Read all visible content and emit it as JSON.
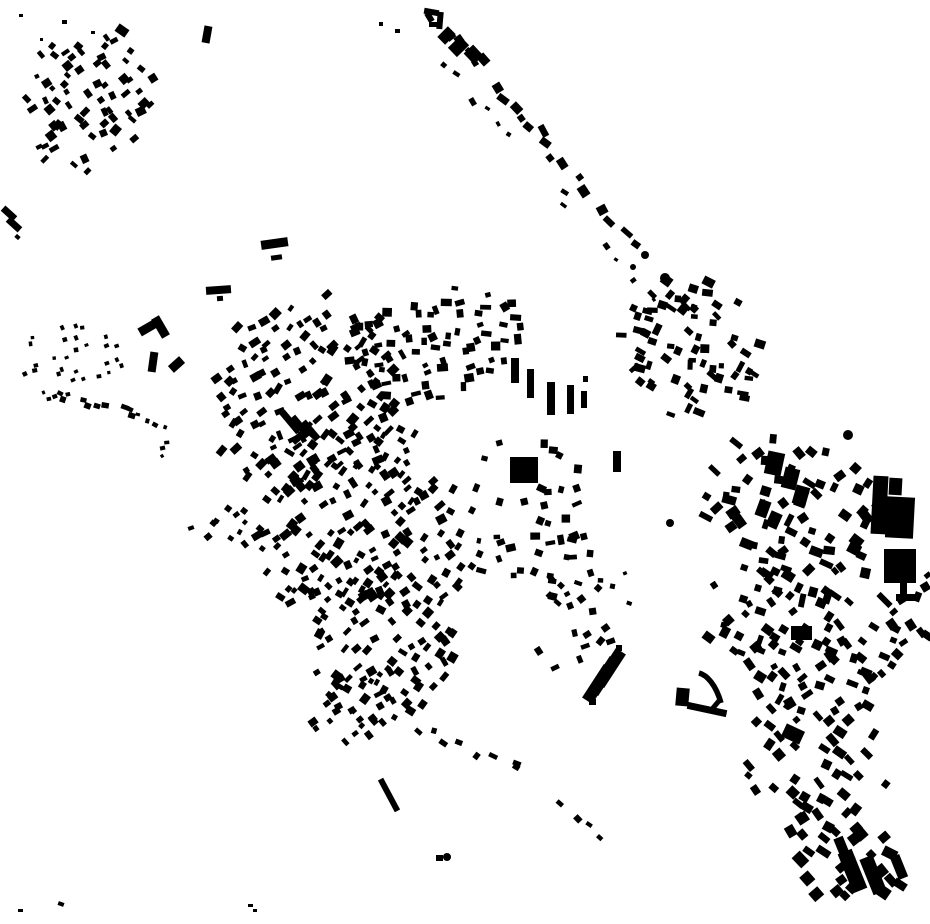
{
  "map": {
    "content": "black building footprints on white background",
    "width": 930,
    "height": 924,
    "background": "#ffffff",
    "building_color": "#000000",
    "holes": [
      [
        505,
        618,
        52,
        40
      ],
      [
        549,
        393,
        50,
        45
      ],
      [
        524,
        470,
        32,
        28
      ]
    ],
    "clusters": [
      {
        "seed": 11,
        "cx": 82,
        "cy": 100,
        "rx": 78,
        "ry": 72,
        "sp": 12,
        "latRot": -38,
        "skip": 0.3,
        "w": [
          4,
          10
        ],
        "h": [
          4,
          9
        ],
        "rot": -38,
        "rotJit": 16
      },
      {
        "seed": 22,
        "cx": 68,
        "cy": 358,
        "rx": 60,
        "ry": 46,
        "sp": 14,
        "latRot": -12,
        "skip": 0.25,
        "w": [
          3,
          5
        ],
        "h": [
          3,
          5
        ],
        "rot": -15,
        "rotJit": 10
      },
      {
        "seed": 25,
        "cx": 160,
        "cy": 452,
        "rx": 22,
        "ry": 16,
        "sp": 11,
        "latRot": -20,
        "skip": 0.4,
        "w": [
          3,
          6
        ],
        "h": [
          3,
          5
        ],
        "rot": -20,
        "rotJit": 15
      },
      {
        "seed": 31,
        "cx": 310,
        "cy": 395,
        "rx": 105,
        "ry": 100,
        "sp": 12,
        "latRot": -40,
        "skip": 0.3,
        "w": [
          5,
          11
        ],
        "h": [
          4,
          9
        ],
        "rot": -40,
        "rotJit": 20
      },
      {
        "seed": 32,
        "cx": 435,
        "cy": 345,
        "rx": 95,
        "ry": 58,
        "sp": 12,
        "latRot": -15,
        "skip": 0.32,
        "w": [
          5,
          11
        ],
        "h": [
          4,
          9
        ],
        "rot": -12,
        "rotJit": 24
      },
      {
        "seed": 33,
        "cx": 350,
        "cy": 520,
        "rx": 120,
        "ry": 85,
        "sp": 12,
        "latRot": -42,
        "skip": 0.34,
        "w": [
          5,
          11
        ],
        "h": [
          4,
          9
        ],
        "rot": -42,
        "rotJit": 20
      },
      {
        "seed": 34,
        "cx": 400,
        "cy": 628,
        "rx": 113,
        "ry": 75,
        "sp": 12,
        "latRot": -45,
        "skip": 0.36,
        "w": [
          5,
          10
        ],
        "h": [
          4,
          9
        ],
        "rot": -45,
        "rotJit": 18
      },
      {
        "seed": 35,
        "cx": 530,
        "cy": 520,
        "rx": 72,
        "ry": 92,
        "sp": 13,
        "latRot": 0,
        "skip": 0.4,
        "w": [
          5,
          10
        ],
        "h": [
          4,
          9
        ],
        "rot": 2,
        "rotJit": 28
      },
      {
        "seed": 36,
        "cx": 560,
        "cy": 618,
        "rx": 58,
        "ry": 55,
        "sp": 13,
        "latRot": -30,
        "skip": 0.45,
        "w": [
          5,
          9
        ],
        "h": [
          4,
          8
        ],
        "rot": -30,
        "rotJit": 22
      },
      {
        "seed": 37,
        "cx": 358,
        "cy": 708,
        "rx": 55,
        "ry": 35,
        "sp": 12,
        "latRot": -45,
        "skip": 0.4,
        "w": [
          4,
          9
        ],
        "h": [
          4,
          8
        ],
        "rot": -45,
        "rotJit": 15
      },
      {
        "seed": 38,
        "cx": 224,
        "cy": 520,
        "rx": 27,
        "ry": 58,
        "sp": 13,
        "latRot": -50,
        "skip": 0.45,
        "w": [
          4,
          8
        ],
        "h": [
          4,
          7
        ],
        "rot": -50,
        "rotJit": 15
      },
      {
        "seed": 41,
        "cx": 690,
        "cy": 345,
        "rx": 80,
        "ry": 74,
        "sp": 12,
        "latRot": 25,
        "skip": 0.34,
        "w": [
          5,
          12
        ],
        "h": [
          4,
          9
        ],
        "rot": 25,
        "rotJit": 24
      },
      {
        "seed": 42,
        "cx": 800,
        "cy": 518,
        "rx": 108,
        "ry": 80,
        "sp": 14,
        "latRot": 30,
        "skip": 0.4,
        "w": [
          6,
          14
        ],
        "h": [
          5,
          11
        ],
        "rot": 30,
        "rotJit": 26
      },
      {
        "seed": 43,
        "cx": 790,
        "cy": 645,
        "rx": 108,
        "ry": 64,
        "sp": 13,
        "latRot": 38,
        "skip": 0.4,
        "w": [
          6,
          12
        ],
        "h": [
          5,
          10
        ],
        "rot": 38,
        "rotJit": 24
      },
      {
        "seed": 44,
        "cx": 805,
        "cy": 758,
        "rx": 88,
        "ry": 74,
        "sp": 14,
        "latRot": 42,
        "skip": 0.45,
        "w": [
          6,
          13
        ],
        "h": [
          5,
          10
        ],
        "rot": 42,
        "rotJit": 20
      },
      {
        "seed": 45,
        "cx": 845,
        "cy": 855,
        "rx": 73,
        "ry": 58,
        "sp": 15,
        "latRot": 42,
        "skip": 0.48,
        "w": [
          8,
          15
        ],
        "h": [
          6,
          12
        ],
        "rot": 42,
        "rotJit": 16
      },
      {
        "seed": 46,
        "cx": 903,
        "cy": 628,
        "rx": 27,
        "ry": 72,
        "sp": 13,
        "latRot": 40,
        "skip": 0.42,
        "w": [
          5,
          11
        ],
        "h": [
          5,
          9
        ],
        "rot": 40,
        "rotJit": 20
      },
      {
        "seed": 47,
        "cx": 625,
        "cy": 580,
        "rx": 26,
        "ry": 32,
        "sp": 14,
        "latRot": 0,
        "skip": 0.6,
        "w": [
          3,
          6
        ],
        "h": [
          3,
          5
        ],
        "rot": 0,
        "rotJit": 30
      }
    ],
    "strips": [
      {
        "seed": 51,
        "x1": 433,
        "y1": 16,
        "x2": 700,
        "y2": 318,
        "sp": 12,
        "spread": 12,
        "skip": 0.28,
        "w": [
          6,
          13
        ],
        "h": [
          5,
          10
        ],
        "rotJit": 14
      },
      {
        "seed": 52,
        "x1": 420,
        "y1": 42,
        "x2": 563,
        "y2": 192,
        "sp": 15,
        "spread": 8,
        "skip": 0.45,
        "w": [
          4,
          8
        ],
        "h": [
          3,
          6
        ],
        "rotJit": 16
      },
      {
        "seed": 53,
        "x1": 567,
        "y1": 205,
        "x2": 655,
        "y2": 300,
        "sp": 14,
        "spread": 10,
        "skip": 0.5,
        "w": [
          3,
          7
        ],
        "h": [
          3,
          6
        ],
        "rotJit": 18
      },
      {
        "seed": 54,
        "x1": 420,
        "y1": 730,
        "x2": 516,
        "y2": 768,
        "sp": 12,
        "spread": 10,
        "skip": 0.3,
        "w": [
          5,
          9
        ],
        "h": [
          4,
          8
        ],
        "rotJit": 20
      },
      {
        "seed": 55,
        "x1": 516,
        "y1": 770,
        "x2": 602,
        "y2": 832,
        "sp": 12,
        "spread": 10,
        "skip": 0.3,
        "w": [
          5,
          9
        ],
        "h": [
          4,
          8
        ],
        "rotJit": 20
      },
      {
        "seed": 23,
        "x1": 58,
        "y1": 394,
        "x2": 130,
        "y2": 413,
        "sp": 8,
        "spread": 8,
        "skip": 0.15,
        "w": [
          5,
          9
        ],
        "h": [
          4,
          7
        ],
        "rotJit": 14
      },
      {
        "seed": 24,
        "x1": 130,
        "y1": 413,
        "x2": 163,
        "y2": 428,
        "sp": 9,
        "spread": 6,
        "skip": 0.3,
        "w": [
          3,
          6
        ],
        "h": [
          3,
          5
        ],
        "rotJit": 14
      }
    ],
    "landmark_rects": [
      [
        511,
        358,
        8,
        25,
        0
      ],
      [
        527,
        369,
        7,
        29,
        0
      ],
      [
        547,
        382,
        8,
        33,
        0
      ],
      [
        567,
        385,
        7,
        29,
        0
      ],
      [
        581,
        391,
        6,
        17,
        0
      ],
      [
        583,
        376,
        5,
        6,
        0
      ],
      [
        613,
        451,
        8,
        21,
        0
      ],
      [
        510,
        457,
        28,
        26,
        0
      ],
      [
        537,
        485,
        9,
        7,
        25
      ],
      [
        138,
        322,
        24,
        9,
        -30
      ],
      [
        156,
        316,
        9,
        22,
        -30
      ],
      [
        149,
        352,
        8,
        20,
        8
      ],
      [
        169,
        360,
        15,
        9,
        -42
      ],
      [
        261,
        239,
        27,
        9,
        -8
      ],
      [
        271,
        255,
        11,
        5,
        -8
      ],
      [
        206,
        286,
        25,
        8,
        -4
      ],
      [
        217,
        296,
        6,
        5,
        -4
      ],
      [
        1,
        210,
        16,
        7,
        42
      ],
      [
        6,
        221,
        16,
        7,
        42
      ],
      [
        15,
        235,
        5,
        4,
        42
      ],
      [
        386,
        777,
        6,
        36,
        -28
      ],
      [
        592,
        664,
        12,
        40,
        33
      ],
      [
        598,
        656,
        12,
        40,
        33
      ],
      [
        604,
        648,
        12,
        40,
        33
      ],
      [
        589,
        699,
        7,
        6,
        0
      ],
      [
        616,
        645,
        6,
        6,
        0
      ],
      [
        676,
        688,
        13,
        18,
        5
      ],
      [
        687,
        706,
        40,
        7,
        12
      ],
      [
        713,
        699,
        5,
        12,
        40
      ],
      [
        872,
        476,
        15,
        58,
        3
      ],
      [
        886,
        497,
        28,
        41,
        3
      ],
      [
        889,
        478,
        13,
        17,
        3
      ],
      [
        884,
        549,
        32,
        34,
        0
      ],
      [
        900,
        583,
        7,
        14,
        0
      ],
      [
        896,
        594,
        22,
        7,
        0
      ],
      [
        876,
        597,
        17,
        6,
        45
      ],
      [
        766,
        452,
        17,
        23,
        12
      ],
      [
        783,
        468,
        15,
        21,
        14
      ],
      [
        794,
        486,
        14,
        19,
        16
      ],
      [
        757,
        500,
        12,
        17,
        20
      ],
      [
        768,
        512,
        12,
        16,
        24
      ],
      [
        791,
        626,
        21,
        14,
        0
      ],
      [
        845,
        850,
        15,
        42,
        -22
      ],
      [
        866,
        856,
        14,
        38,
        -22
      ],
      [
        894,
        855,
        10,
        24,
        -22
      ],
      [
        836,
        837,
        10,
        16,
        -22
      ],
      [
        783,
        727,
        20,
        14,
        25
      ],
      [
        424,
        9,
        15,
        6,
        10
      ],
      [
        437,
        12,
        6,
        17,
        5
      ],
      [
        429,
        22,
        8,
        5,
        0
      ],
      [
        441,
        28,
        11,
        15,
        45
      ],
      [
        452,
        38,
        13,
        17,
        46
      ],
      [
        466,
        48,
        15,
        13,
        47
      ],
      [
        478,
        55,
        11,
        9,
        48
      ],
      [
        116,
        26,
        12,
        9,
        35
      ],
      [
        203,
        26,
        8,
        17,
        10
      ],
      [
        287,
        409,
        7,
        26,
        -40
      ],
      [
        297,
        414,
        7,
        25,
        -40
      ],
      [
        307,
        419,
        7,
        23,
        -40
      ],
      [
        290,
        431,
        24,
        7,
        -40
      ],
      [
        18,
        909,
        5,
        3,
        0
      ],
      [
        58,
        902,
        6,
        4,
        20
      ],
      [
        248,
        904,
        5,
        3,
        0
      ],
      [
        253,
        909,
        4,
        3,
        0
      ],
      [
        19,
        14,
        4,
        3,
        0
      ],
      [
        62,
        20,
        5,
        4,
        0
      ],
      [
        91,
        31,
        4,
        3,
        0
      ],
      [
        40,
        38,
        3,
        3,
        0
      ],
      [
        379,
        22,
        4,
        4,
        0
      ],
      [
        395,
        29,
        5,
        4,
        0
      ],
      [
        436,
        855,
        7,
        6,
        0
      ],
      [
        188,
        526,
        6,
        4,
        -20
      ]
    ],
    "landmark_circles": [
      [
        848,
        435,
        5
      ],
      [
        665,
        278,
        5
      ],
      [
        645,
        255,
        4
      ],
      [
        670,
        523,
        4
      ],
      [
        447,
        857,
        4
      ],
      [
        633,
        267,
        3
      ]
    ],
    "landmark_paths": [
      {
        "d": "M699,673 C707,675 716,685 721,703",
        "w": 5.5
      }
    ]
  }
}
